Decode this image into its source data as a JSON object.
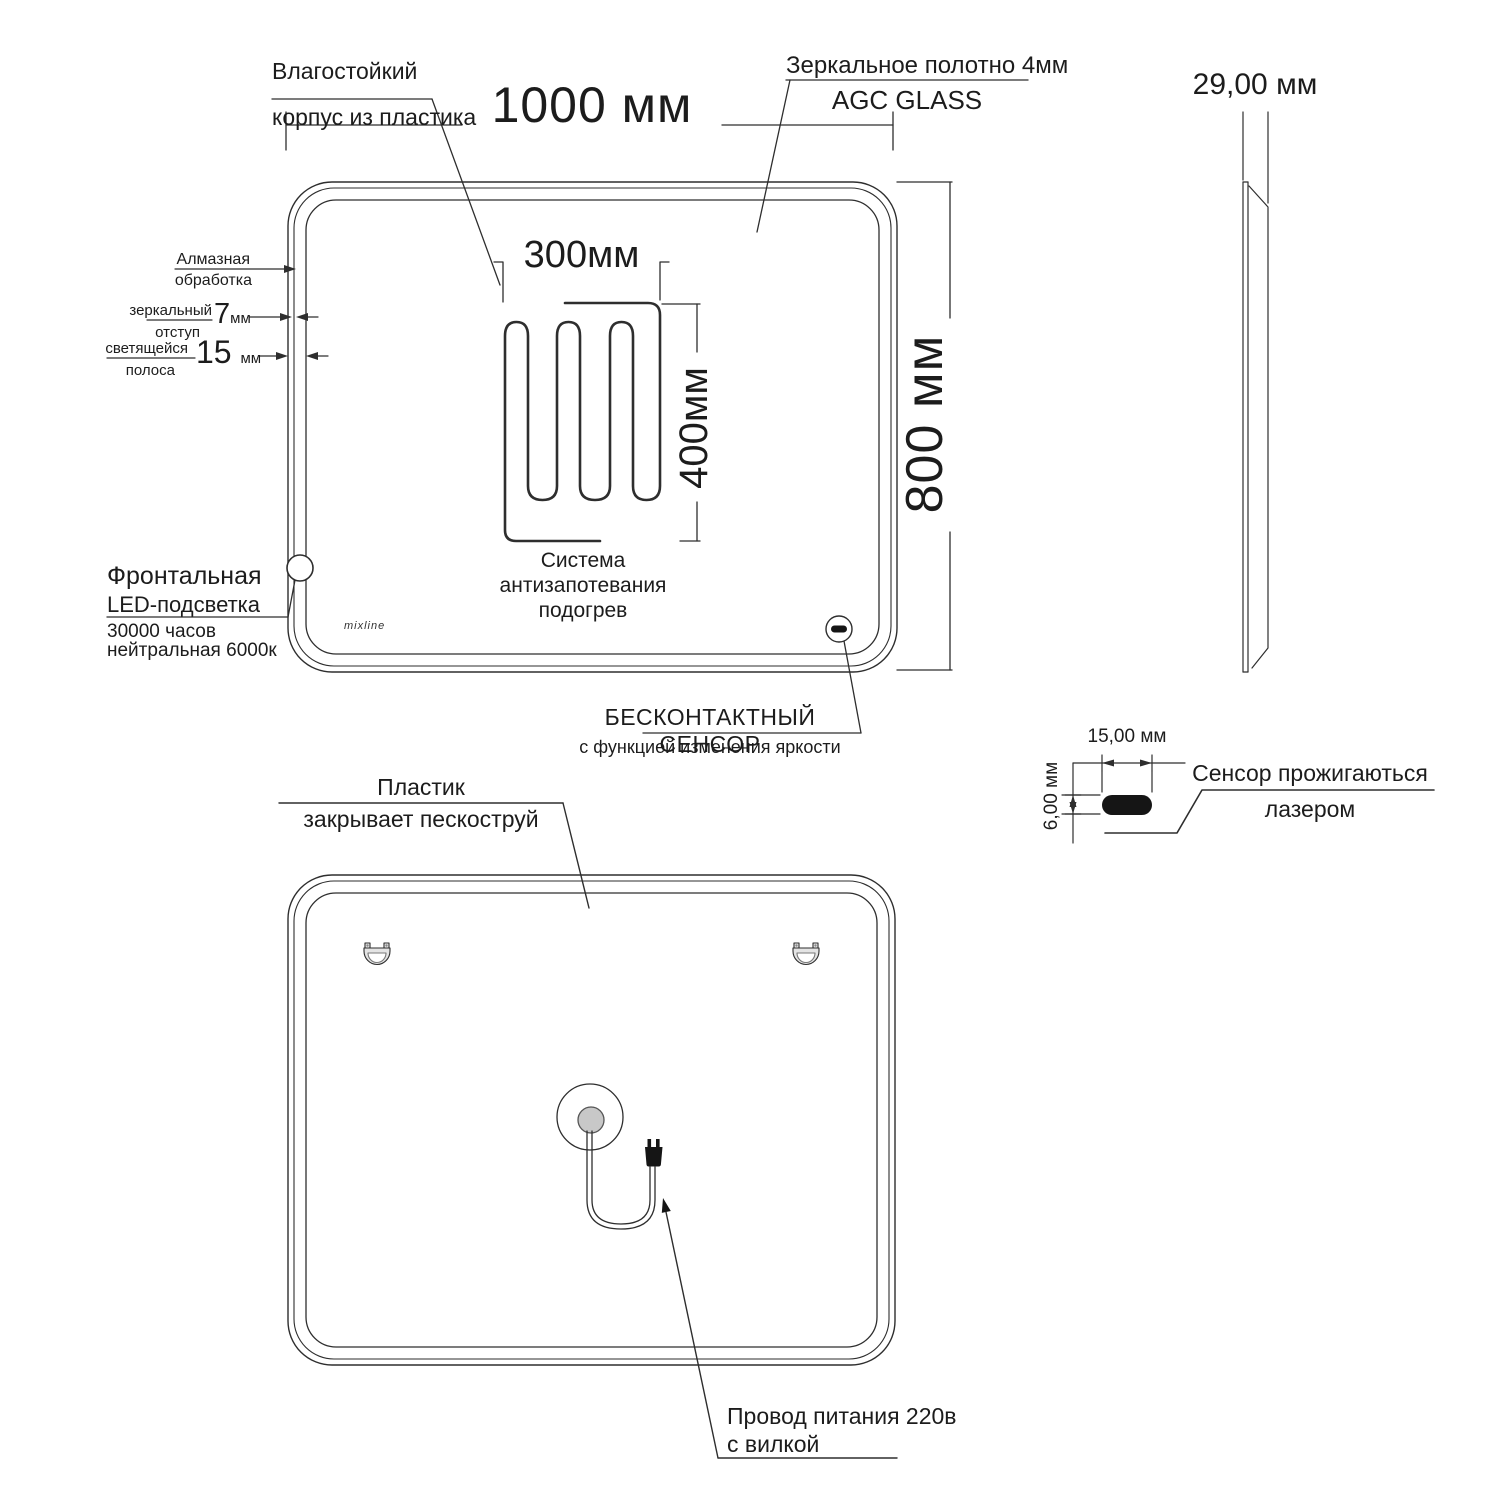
{
  "colors": {
    "line": "#2e2e2e",
    "text": "#1c1c1c",
    "fill_dark": "#151515",
    "fill_gray": "#c8c8c8"
  },
  "front_view": {
    "dim_width": "1000 мм",
    "dim_height": "800 мм",
    "case_label_line1": "Влагостойкий",
    "case_label_line2": "корпус из пластика",
    "glass_label_line1": "Зеркальное  полотно 4мм",
    "glass_label_line2": "AGC GLASS",
    "edge_label_line1": "Алмазная",
    "edge_label_line2": "обработка",
    "offset_label_line1": "зеркальный",
    "offset_label_line2": "отступ",
    "offset_value": "7",
    "offset_unit": "мм",
    "strip_label_line1": "светящейся",
    "strip_label_line2": "полоса",
    "strip_value": "15",
    "strip_unit": "мм",
    "led_label_line1": "Фронтальная",
    "led_label_line2": "LED-подсветка",
    "led_label_line3": "30000 часов",
    "led_label_line4": "нейтральная 6000к",
    "brand": "mixline",
    "sensor_label_line1": "БЕСКОНТАКТНЫЙ СЕНСОР",
    "sensor_label_line2": "с функцией изменения яркости",
    "heater": {
      "dim_width": "300мм",
      "dim_height": "400мм",
      "caption_line1": "Система",
      "caption_line2": "антизапотевания",
      "caption_line3": "подогрев"
    }
  },
  "side_view": {
    "dim_depth": "29,00 мм"
  },
  "sensor_detail": {
    "dim_width": "15,00 мм",
    "dim_height": "6,00 мм",
    "label_line1": "Сенсор прожигаються",
    "label_line2": "лазером"
  },
  "back_view": {
    "plastic_label_line1": "Пластик",
    "plastic_label_line2": "закрывает пескоструй",
    "cable_label_line1": "Провод питания 220в",
    "cable_label_line2": "с вилкой"
  }
}
